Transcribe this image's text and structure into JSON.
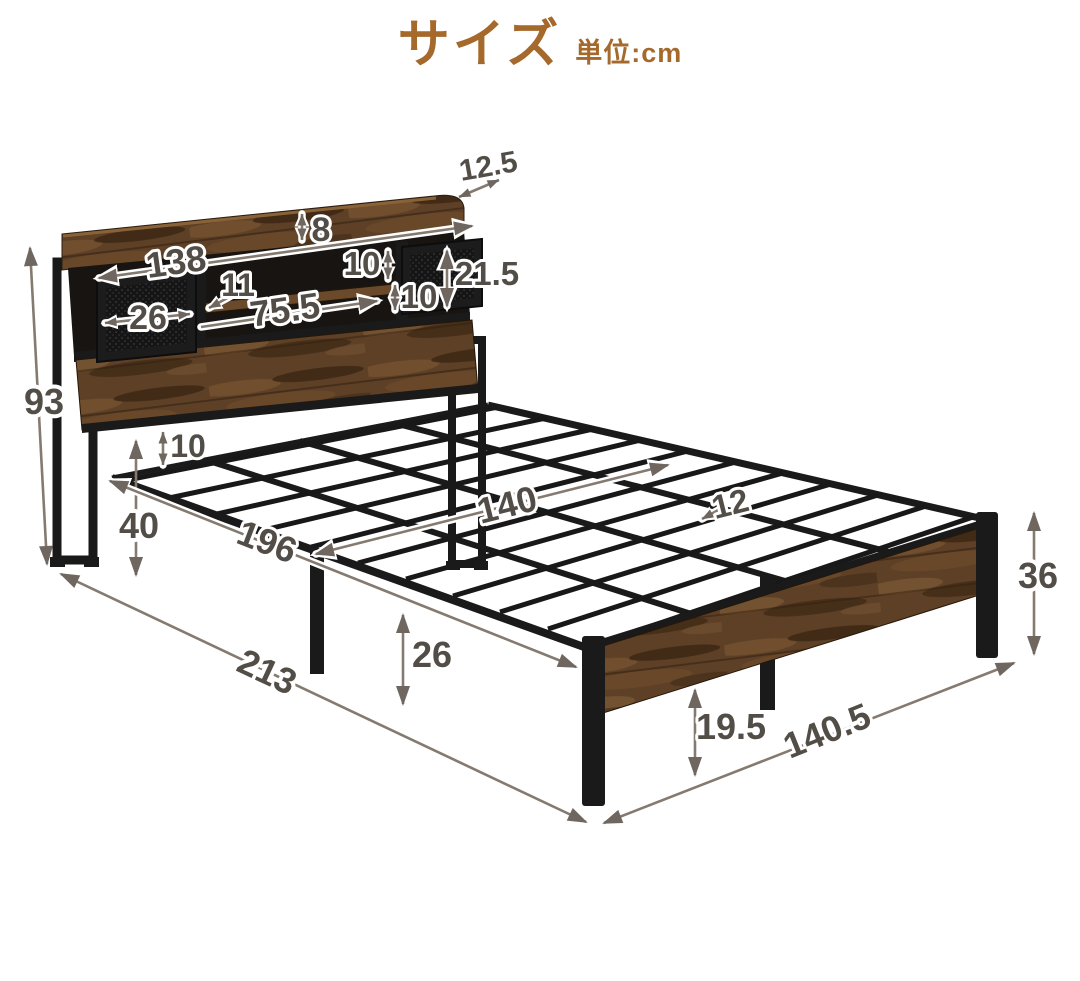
{
  "header": {
    "title": "サイズ",
    "unit": "単位:cm"
  },
  "colors": {
    "title_brown": "#a5692c",
    "dimension_text": "#524d47",
    "dimension_line": "#847a70",
    "wood": "#5e4026",
    "metal": "#1a1a1a",
    "background": "#ffffff"
  },
  "dimensions": {
    "shelf_depth": "12.5",
    "shelf_lip_height": "8",
    "headboard_width": "138",
    "shelf_divider": "11",
    "door_width": "26",
    "open_shelf_width": "75.5",
    "shelf_upper_height": "10",
    "shelf_lower_height": "10",
    "door_height": "21.5",
    "headboard_height": "93",
    "frame_to_slat_gap": "10",
    "floor_to_slat_height": "40",
    "inner_length": "196",
    "inner_width": "140",
    "slat_spacing": "12",
    "under_bed_clearance": "26",
    "total_length": "213",
    "footboard_height": "36",
    "footboard_clearance": "19.5",
    "total_width": "140.5"
  }
}
